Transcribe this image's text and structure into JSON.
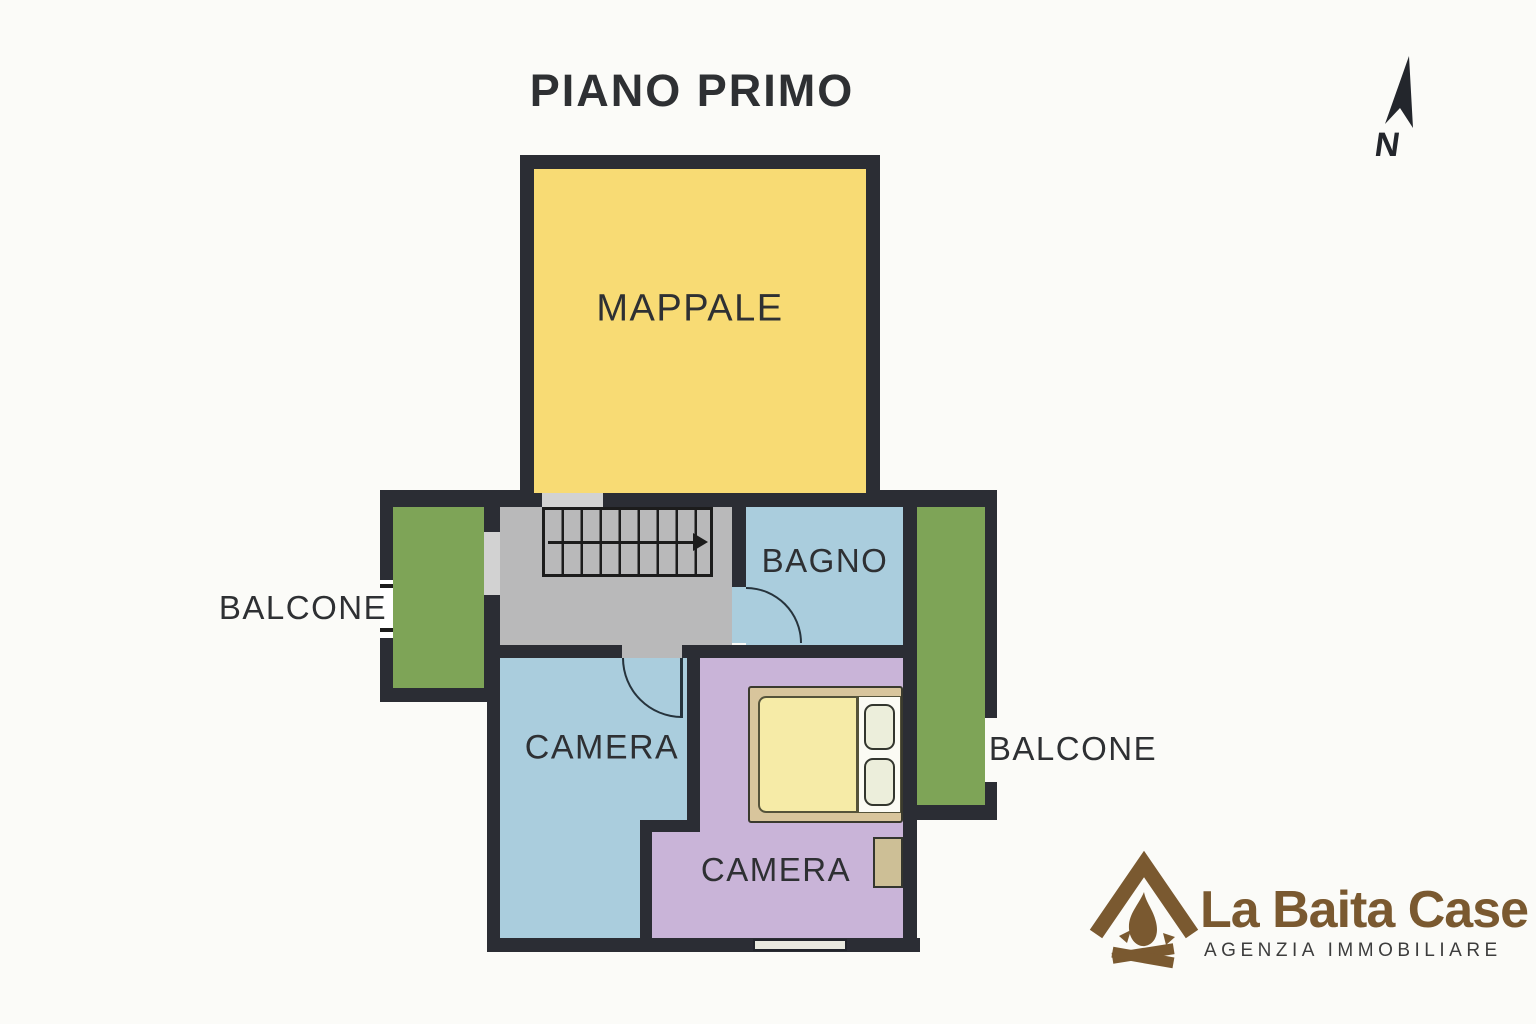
{
  "title": "PIANO PRIMO",
  "compass": {
    "label": "N",
    "icon": "north-arrow-icon"
  },
  "rooms": {
    "mappale": {
      "label": "MAPPALE"
    },
    "bagno": {
      "label": "BAGNO"
    },
    "balcone_left": {
      "label": "BALCONE"
    },
    "camera_left": {
      "label": "CAMERA"
    },
    "camera_right": {
      "label": "CAMERA"
    },
    "balcone_right": {
      "label": "BALCONE"
    }
  },
  "features": {
    "staircase": "stairs-with-direction-arrow",
    "doors": [
      "door-arc-camera-left",
      "door-arc-bagno"
    ],
    "furniture": [
      "double-bed-with-pillows",
      "nightstand"
    ],
    "windows": [
      "balcony-left-window",
      "camera-right-bottom-window"
    ]
  },
  "logo": {
    "icon": "campfire-house-icon",
    "name": "La Baita Case",
    "tagline": "AGENZIA IMMOBILIARE"
  },
  "colors": {
    "background": "#fbfbf8",
    "wall_dark": "#2b2d34",
    "mappale_yellow": "#f8db74",
    "room_blue": "#aacddd",
    "room_purple": "#c9b4d8",
    "balcony_green": "#7ea457",
    "hall_gray": "#b9b9ba",
    "threshold_gray": "#d2d2d2",
    "window_light": "#e9e9df",
    "bed_frame_tan": "#d8c59c",
    "mattress_yellow": "#f6eba7",
    "pillow_cream": "#eceedb",
    "pillow_area_white": "#fbfbf4",
    "furniture_tan": "#cdbf96",
    "label_dark": "#2e3033",
    "logo_brown": "#7a5930",
    "logo_subtext": "#3d3d3d"
  }
}
